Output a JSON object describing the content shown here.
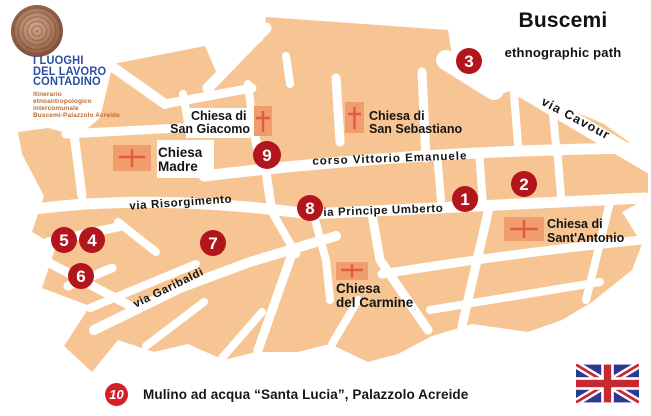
{
  "header": {
    "title": "Buscemi",
    "subtitle": "ethnographic path"
  },
  "logo": {
    "title_lines": [
      "I LUOGHI",
      "DEL LAVORO",
      "CONTADINO"
    ],
    "subtitle_lines": [
      "itinerario",
      "etnoantropologico",
      "intercomunale",
      "Buscemi-Palazzolo Acreide"
    ],
    "colors": {
      "title_blue": "#2c4da0",
      "subtitle_orange": "#be6b35",
      "seal_brown": "#9c6a50"
    }
  },
  "map": {
    "colors": {
      "block_orange": "#f7c593",
      "street_white": "#ffffff",
      "church_fill": "#f09c6c",
      "church_cross": "#e25a44",
      "marker_red": "#b2151c"
    },
    "streets": [
      {
        "name": "via Cavour"
      },
      {
        "name": "corso Vittorio Emanuele"
      },
      {
        "name": "via Principe Umberto"
      },
      {
        "name": "via Risorgimento"
      },
      {
        "name": "via Garibaldi"
      }
    ],
    "churches": [
      {
        "id": "san-giacomo",
        "lines": [
          "Chiesa di",
          "San Giacomo"
        ]
      },
      {
        "id": "san-sebastiano",
        "lines": [
          "Chiesa di",
          "San Sebastiano"
        ]
      },
      {
        "id": "madre",
        "lines": [
          "Chiesa",
          "Madre"
        ]
      },
      {
        "id": "sant-antonio",
        "lines": [
          "Chiesa di",
          "Sant'Antonio"
        ]
      },
      {
        "id": "carmine",
        "lines": [
          "Chiesa",
          "del Carmine"
        ]
      }
    ],
    "markers": [
      {
        "label": "1"
      },
      {
        "label": "2"
      },
      {
        "label": "3"
      },
      {
        "label": "4"
      },
      {
        "label": "5"
      },
      {
        "label": "6"
      },
      {
        "label": "7"
      },
      {
        "label": "8"
      },
      {
        "label": "9"
      }
    ]
  },
  "footer": {
    "marker_label": "10",
    "text": "Mulino ad acqua “Santa Lucia”, Palazzolo Acreide"
  },
  "flag": {
    "colors": {
      "blue": "#2b3a8c",
      "red": "#c62a30"
    }
  }
}
